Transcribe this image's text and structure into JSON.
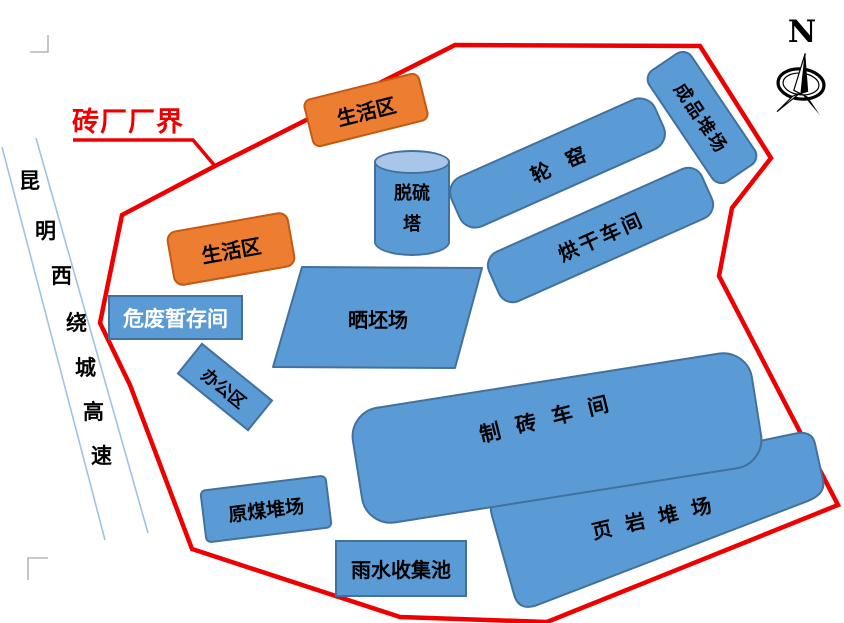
{
  "boundary": {
    "label": "砖厂厂界"
  },
  "compass": {
    "north_label": "N"
  },
  "road": {
    "name": "昆明西绕城高速",
    "chars": [
      "昆",
      "明",
      "西",
      "绕",
      "城",
      "高",
      "速"
    ]
  },
  "facilities": {
    "living_area": "生活区",
    "desulfurization_tower_line1": "脱硫",
    "desulfurization_tower_line2": "塔",
    "ring_kiln": "轮窑",
    "drying_workshop": "烘干车间",
    "finished_product_yard": "成品堆场",
    "brick_drying_field": "晒坯场",
    "hazardous_waste_storage": "危废暂存间",
    "office_area": "办公区",
    "brick_workshop": "制砖车间",
    "shale_yard": "页岩堆场",
    "raw_coal_yard": "原煤堆场",
    "rainwater_pool": "雨水收集池"
  },
  "colors": {
    "boundary_red": "#ee0000",
    "facility_blue": "#5b9bd5",
    "facility_blue_border": "#41719c",
    "tower_top": "#a8c7e8",
    "living_orange": "#ed7d31",
    "living_orange_border": "#c45911",
    "road_line": "#9dc3e6",
    "mark_gray": "#a6a6a6"
  }
}
